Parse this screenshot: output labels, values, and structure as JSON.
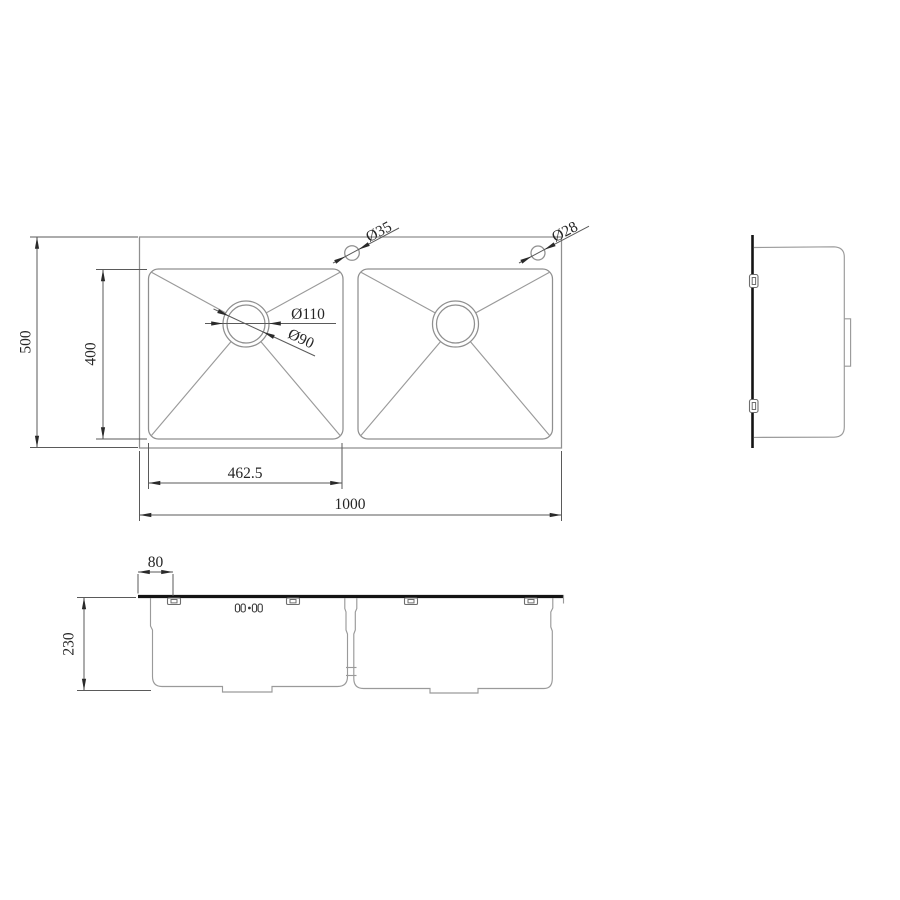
{
  "drawing": {
    "type": "technical-drawing",
    "subject": "double-bowl-kitchen-sink",
    "colors": {
      "background": "#ffffff",
      "geometry_line": "#8f8f8f",
      "dimension_line": "#5a5a5a",
      "ink": "#262626",
      "thick_edge": "#141414"
    },
    "top_view": {
      "dims": {
        "overall_width": "1000",
        "overall_depth": "500",
        "bowl_inner_width": "462.5",
        "bowl_inner_depth": "400",
        "drain_flange_dia": "Ø110",
        "drain_hole_dia": "Ø90",
        "faucet_hole_left_dia": "Ø35",
        "faucet_hole_right_dia": "Ø28"
      }
    },
    "front_view": {
      "dims": {
        "bowl_depth": "230",
        "clip_edge_offset": "80"
      },
      "marking": "00·00"
    },
    "side_view": {}
  }
}
